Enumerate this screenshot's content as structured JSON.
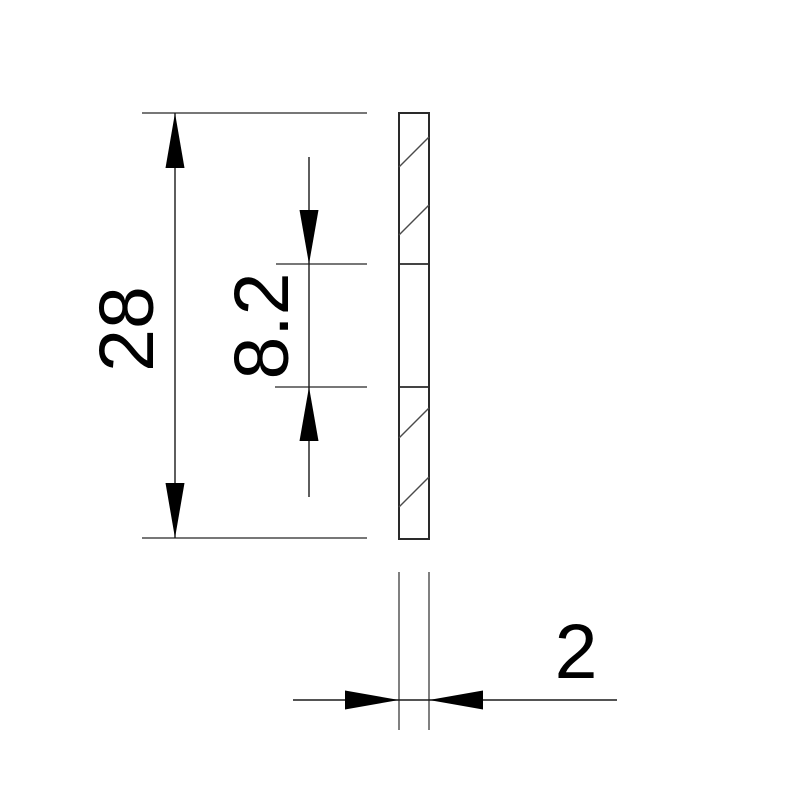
{
  "drawing": {
    "type": "technical-dimension-drawing",
    "view": "side-section-of-thin-plate",
    "background": "#ffffff",
    "colors": {
      "thin_line": "#4a4a4a",
      "part_outline": "#2a2a2a",
      "dimension_text": "#000000",
      "arrowhead": "#000000"
    },
    "dimensions": {
      "overall_height": {
        "label": "28",
        "orientation": "vertical"
      },
      "middle_section": {
        "label": "8.2",
        "orientation": "vertical"
      },
      "thickness": {
        "label": "2",
        "orientation": "horizontal"
      }
    }
  }
}
